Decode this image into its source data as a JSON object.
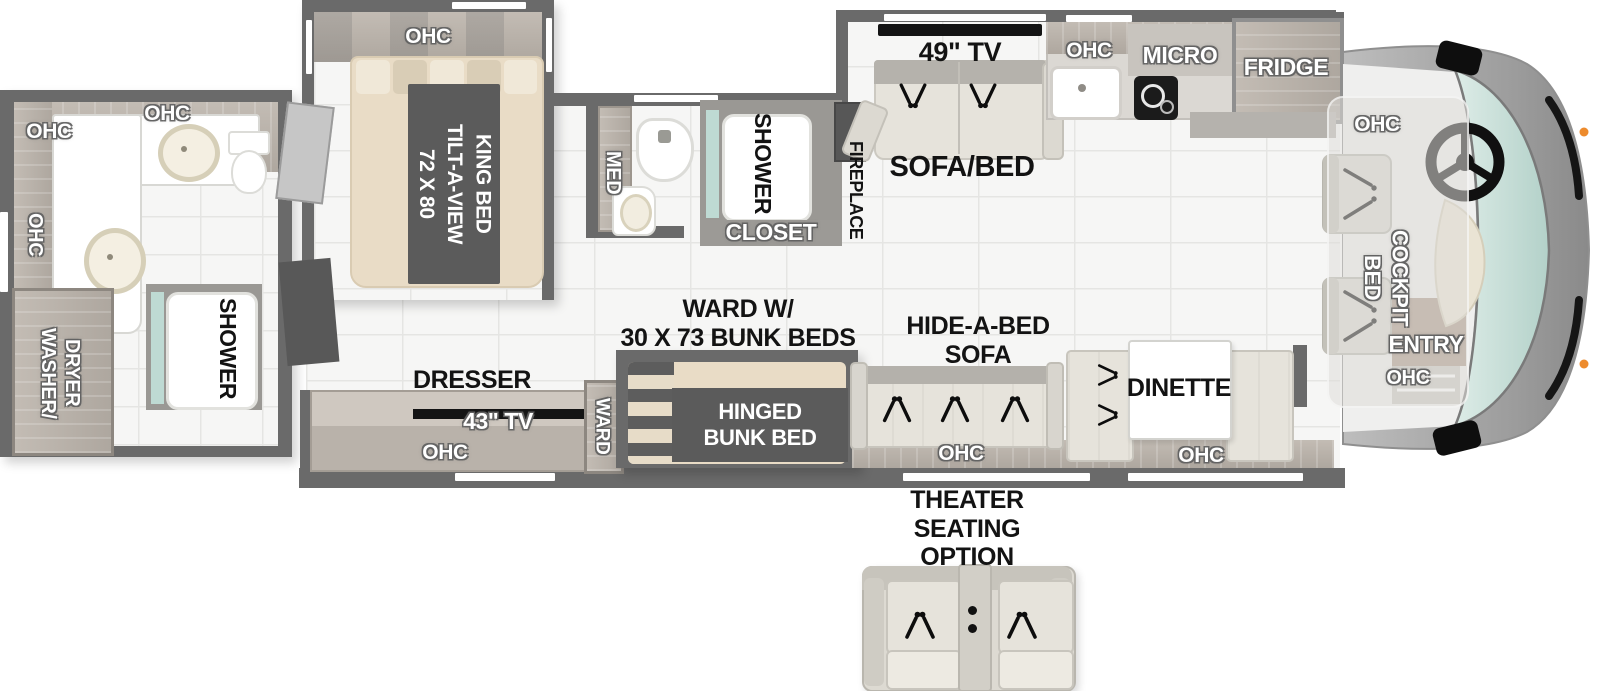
{
  "colors": {
    "wall": "#6a6a6a",
    "wood": "#c3bcb4",
    "wood_dark": "#aea79f",
    "mattress": "#e9dcc6",
    "runner": "#5b5b5b",
    "floor": "#f6f6f5",
    "glass": "#bedad3",
    "windshield": "#cfe4de",
    "sofa": "#e6e3db",
    "tv": "#141414",
    "counter": "#ffffff",
    "cap_gray": "#a2a2a2",
    "marker_orange": "#ed8b2d"
  },
  "rear_bath": {
    "ohc_top_left": "OHC",
    "ohc_top": "OHC",
    "ohc_side": "OHC",
    "washer_dryer": "WASHER/\nDRYER",
    "shower": "SHOWER"
  },
  "bedroom": {
    "ohc": "OHC",
    "king_bed": "72 X 80\nTILT-A-VIEW\nKING BED",
    "dresser": "DRESSER",
    "tv": "43\" TV",
    "ohc_bottom": "OHC",
    "ward": "WARD"
  },
  "mid_bath": {
    "med": "MED",
    "shower": "SHOWER",
    "closet": "CLOSET"
  },
  "living": {
    "fireplace": "FIREPLACE",
    "tv": "49\" TV",
    "sofa_bed": "SOFA/BED",
    "bunk_caption": "WARD W/\n30 X 73 BUNK BEDS",
    "hinged_bunk": "HINGED\nBUNK BED",
    "hide_a_bed": "HIDE-A-BED\nSOFA",
    "hide_a_bed_ohc": "OHC",
    "dinette": "DINETTE",
    "dinette_ohc": "OHC"
  },
  "kitchen": {
    "ohc": "OHC",
    "micro": "MICRO",
    "fridge": "FRIDGE"
  },
  "cockpit": {
    "ohc_top": "OHC",
    "bed": "COCKPIT\nBED",
    "entry": "ENTRY",
    "ohc_bottom": "OHC"
  },
  "options": {
    "theater": "THEATER SEATING\nOPTION"
  }
}
